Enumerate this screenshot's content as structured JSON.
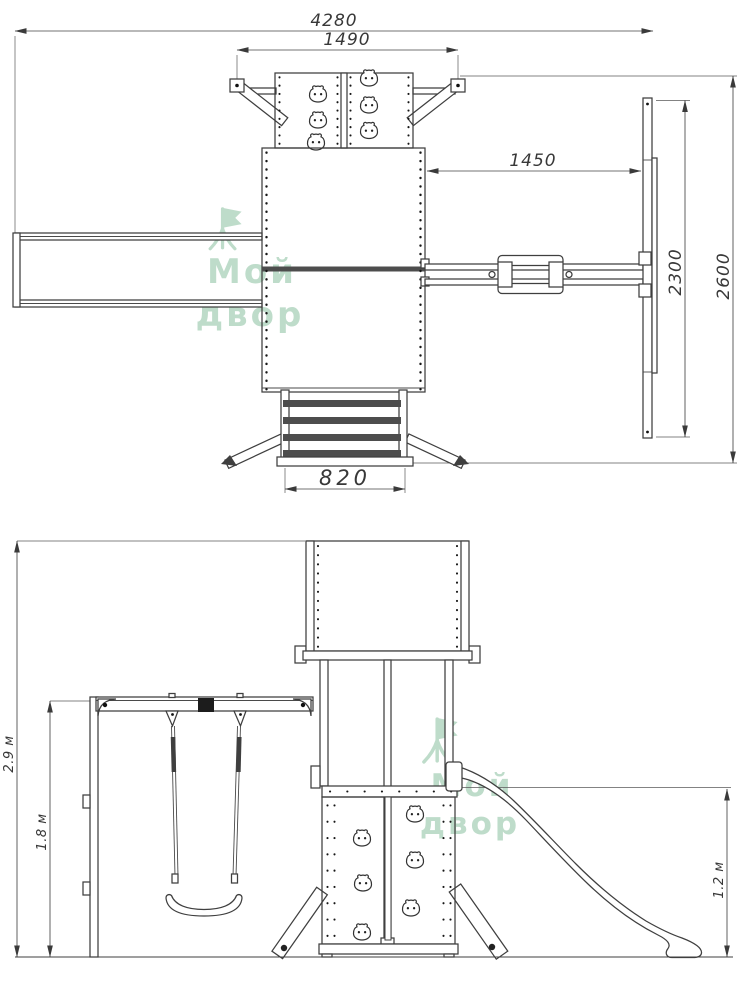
{
  "drawing": {
    "type": "technical drawing of playground set",
    "plan_view": {
      "dims": {
        "overall_width": "4280",
        "climber_width": "1490",
        "beam_span": "1450",
        "aframe_depth": "2300",
        "overall_depth": "2600",
        "ladder_width": "820"
      }
    },
    "elevation_view": {
      "dims": {
        "total_height": "2.9 м",
        "swing_frame_height": "1.8 м",
        "slide_height": "1.2 м"
      }
    },
    "watermark": {
      "line1": "Мой",
      "line2": "двор",
      "color": "#aed3bd"
    }
  }
}
